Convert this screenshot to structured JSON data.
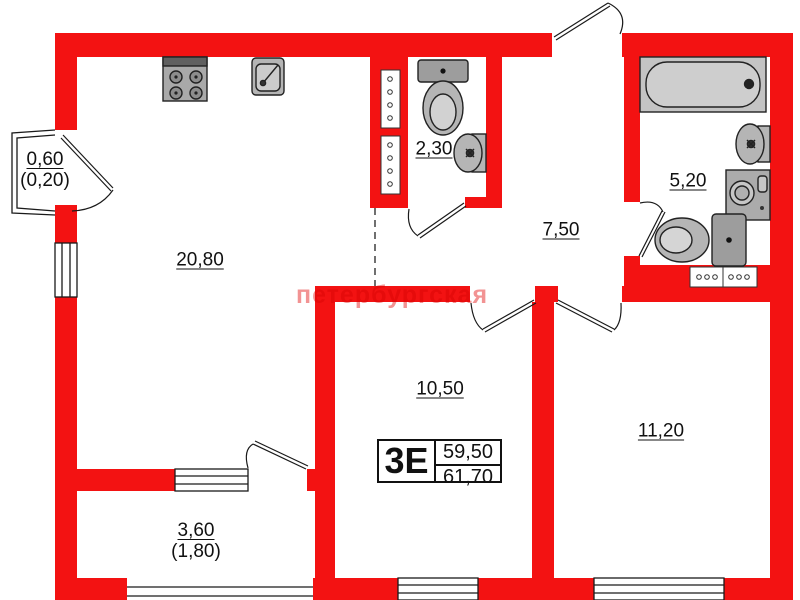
{
  "plan": {
    "watermark": "петербургская",
    "unit": {
      "type_label": "3Е",
      "living_area": "59,50",
      "total_area": "61,70"
    },
    "rooms": {
      "living_kitchen": {
        "area": "20,80"
      },
      "wc": {
        "area": "2,30"
      },
      "hall": {
        "area": "7,50"
      },
      "bathroom": {
        "area": "5,20"
      },
      "room1": {
        "area": "10,50"
      },
      "room2": {
        "area": "11,20"
      },
      "balcony": {
        "area": "3,60",
        "reduced": "(1,80)"
      },
      "bay": {
        "area": "0,60",
        "reduced": "(0,20)"
      }
    },
    "colors": {
      "wall": "#f31212",
      "fixture": "#b8b8b8",
      "outline": "#1a1a1a",
      "watermark": "#f08080"
    }
  }
}
